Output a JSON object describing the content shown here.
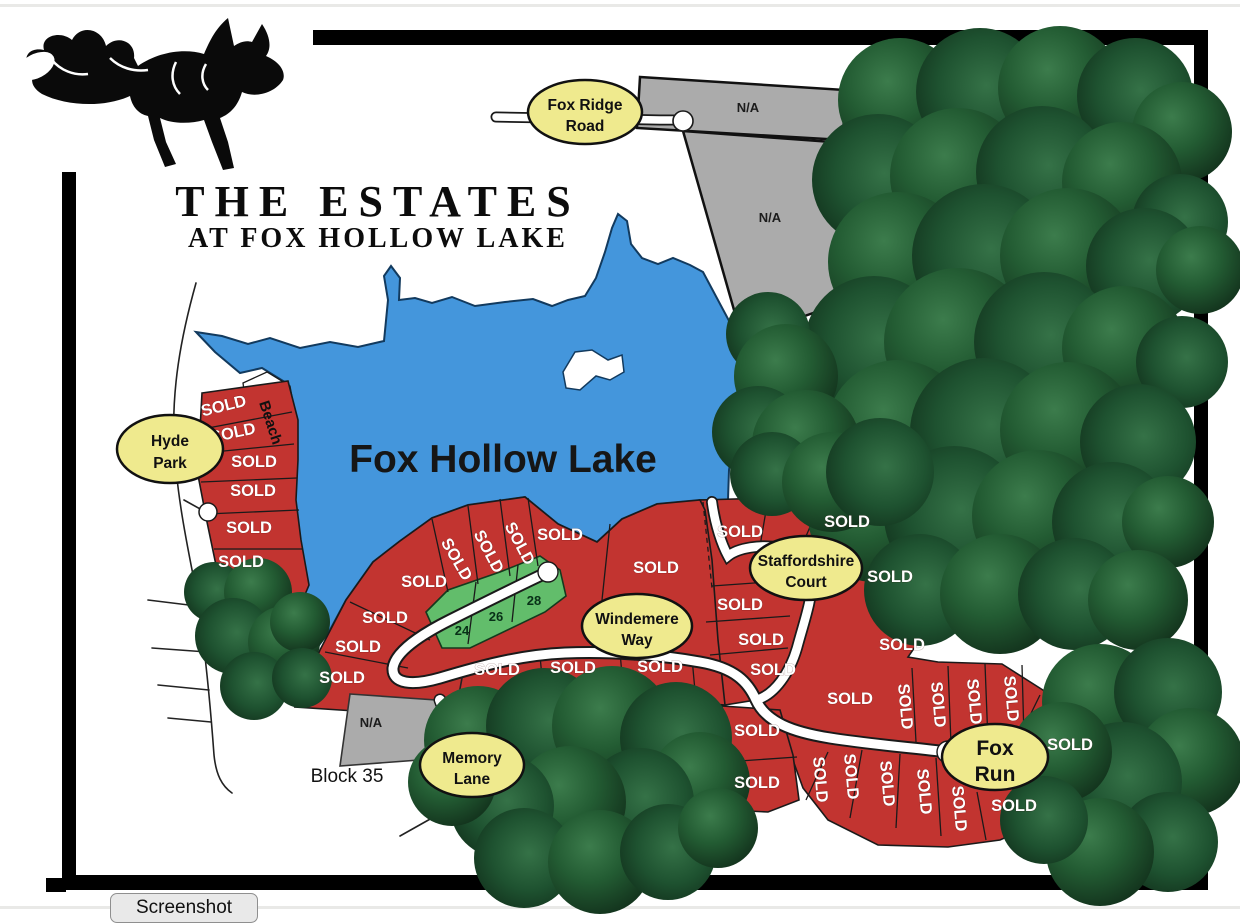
{
  "browser": {
    "screenshot_button_label": "Screenshot"
  },
  "map": {
    "title_line1": "THE ESTATES",
    "title_line2": "AT FOX HOLLOW LAKE",
    "lake_name": "Fox Hollow Lake",
    "beach_label": "Beach",
    "block_label": "Block 35",
    "sold_label": "SOLD",
    "na_label": "N/A",
    "available_lot_numbers": {
      "0": "24",
      "1": "26",
      "2": "28"
    },
    "streets": {
      "fox_ridge_road": {
        "line1": "Fox Ridge",
        "line2": "Road"
      },
      "hyde_park": {
        "line1": "Hyde",
        "line2": "Park"
      },
      "windemere_way": {
        "line1": "Windemere",
        "line2": "Way"
      },
      "staffordshire_court": {
        "line1": "Staffordshire",
        "line2": "Court"
      },
      "memory_lane": {
        "line1": "Memory",
        "line2": "Lane"
      },
      "fox_run": {
        "line1": "Fox",
        "line2": "Run"
      }
    },
    "colors": {
      "sold_lot": "#c23430",
      "available_lot": "#62bd6b",
      "na_lot": "#ababab",
      "lake": "#4496dc",
      "street_oval": "#efea8e",
      "frame": "#000000"
    }
  }
}
